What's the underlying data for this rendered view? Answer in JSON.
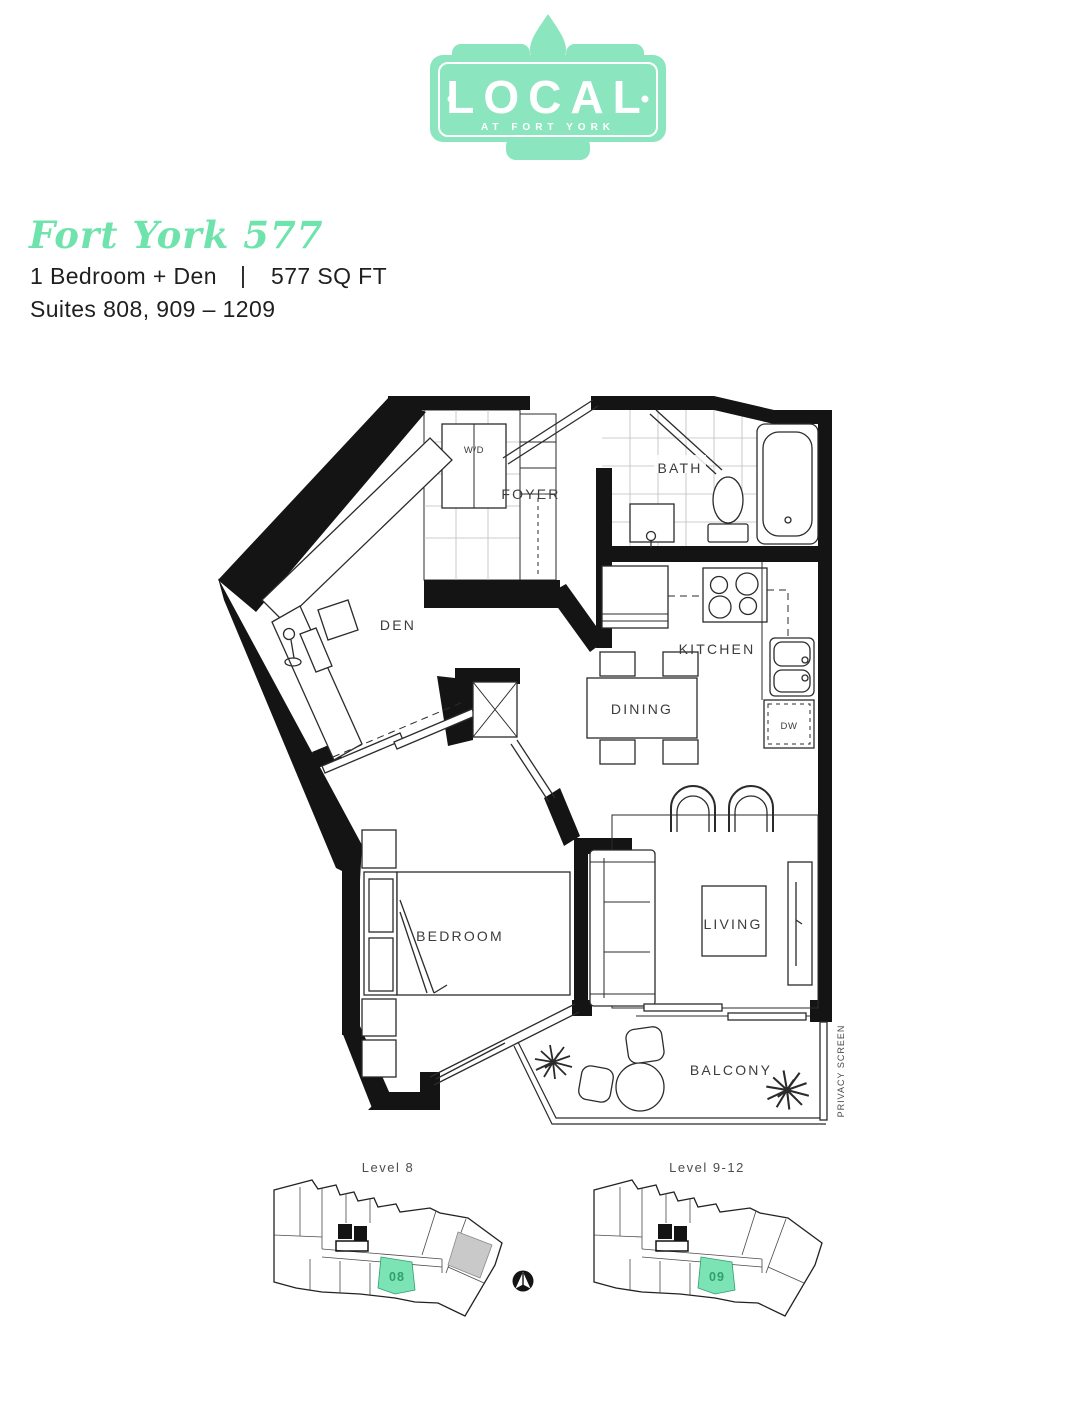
{
  "header": {
    "logo": {
      "name": "LOCAL",
      "tagline": "AT FORT YORK"
    },
    "title": "Fort York 577",
    "spec": "1 Bedroom + Den",
    "separator": "|",
    "area": "577 SQ FT",
    "suites": "Suites 808, 909 – 1209"
  },
  "plan": {
    "rooms": {
      "foyer": "FOYER",
      "bath": "BATH",
      "den": "DEN",
      "kitchen": "KITCHEN",
      "dining": "DINING",
      "bedroom": "BEDROOM",
      "living": "LIVING",
      "balcony": "BALCONY"
    },
    "fixtures": {
      "washer_dryer": "W/D",
      "dishwasher": "DW",
      "privacy_screen": "PRIVACY SCREEN"
    }
  },
  "keyplans": [
    {
      "label": "Level 8",
      "unit": "08"
    },
    {
      "label": "Level 9-12",
      "unit": "09"
    }
  ],
  "colors": {
    "mint": "#8BE6BF",
    "title_green": "#6FE3AC",
    "unit_fill": "#7CE4B4",
    "unit_text": "#2F9E6F",
    "grey_unit": "#C9C9C9"
  }
}
